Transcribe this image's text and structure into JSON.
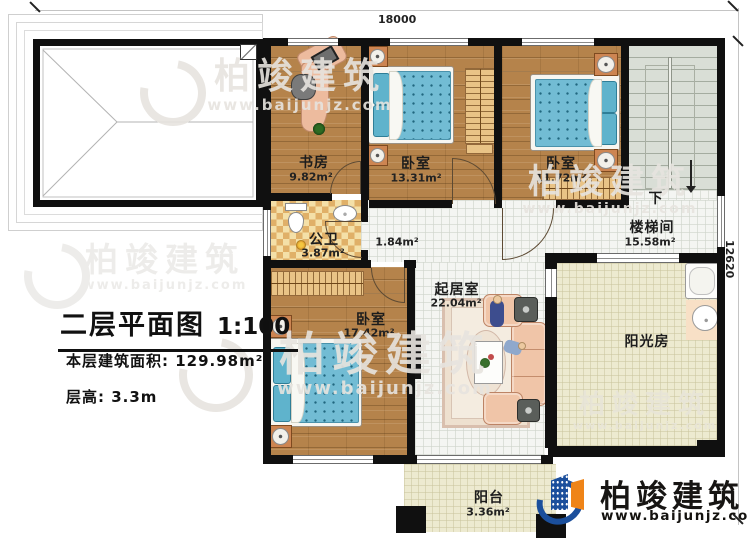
{
  "dimensions": {
    "width": "18000",
    "height": "12620"
  },
  "rooms": {
    "study": {
      "name": "书房",
      "area": "9.82m²"
    },
    "bedroom_top": {
      "name": "卧室",
      "area": "13.31m²"
    },
    "bedroom_right": {
      "name": "卧室",
      "area": "11.72m²"
    },
    "bathroom": {
      "name": "公卫",
      "area": "3.87m²"
    },
    "hallway": {
      "area": "1.84m²"
    },
    "stairwell": {
      "name": "楼梯间",
      "area": "15.58m²",
      "direction_label": "下"
    },
    "living_room": {
      "name": "起居室",
      "area": "22.04m²"
    },
    "bedroom_left": {
      "name": "卧室",
      "area": "17.42m²"
    },
    "sunroom": {
      "name": "阳光房"
    },
    "balcony": {
      "name": "阳台",
      "area": "3.36m²"
    }
  },
  "title_block": {
    "title": "二层平面图",
    "scale": "1:100",
    "floor_area": "本层建筑面积: 129.98m²",
    "floor_height": "层高: 3.3m"
  },
  "branding": {
    "company": "柏竣建筑",
    "website": "www.baijunjz.com"
  },
  "watermark": {
    "text": "柏竣建筑",
    "url": "www.baijunjz.com"
  }
}
